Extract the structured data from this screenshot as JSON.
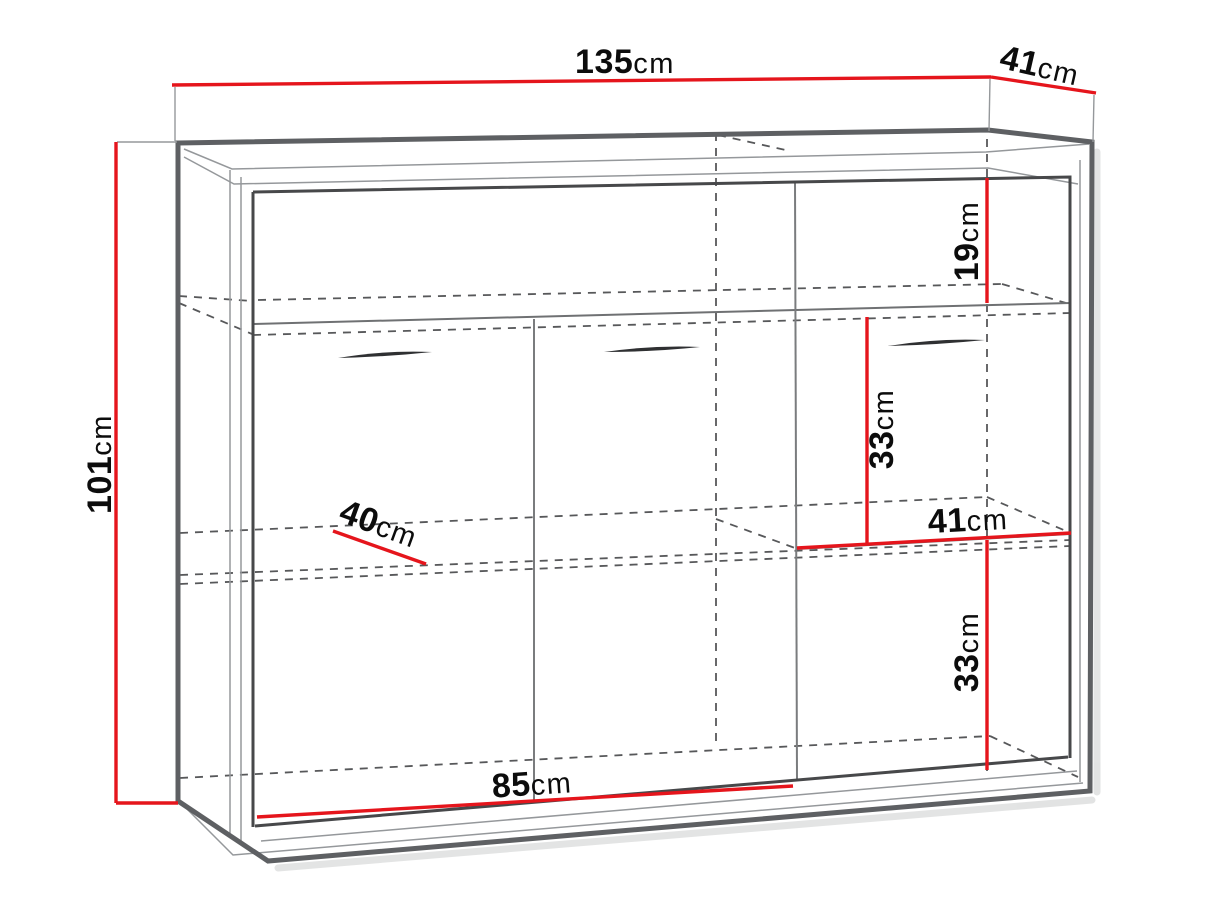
{
  "diagram": {
    "type": "furniture-dimension-diagram",
    "subject": "sideboard cabinet technical line drawing with red dimension lines",
    "background_color": "#ffffff",
    "accent_color": "#e5151c",
    "outline_color": "#5e6063",
    "hidden_line_color": "#57585a",
    "label_color": "#0c0c0c",
    "dimensions": {
      "width_total": {
        "value": "135",
        "unit": "cm",
        "label": "135cm"
      },
      "depth_total": {
        "value": "41",
        "unit": "cm",
        "label": "41cm"
      },
      "height_total": {
        "value": "101",
        "unit": "cm",
        "label": "101cm"
      },
      "top_niche_height": {
        "value": "19",
        "unit": "cm",
        "label": "19cm"
      },
      "right_upper_height": {
        "value": "33",
        "unit": "cm",
        "label": "33cm"
      },
      "right_compartment_width": {
        "value": "41",
        "unit": "cm",
        "label": "41cm"
      },
      "right_lower_height": {
        "value": "33",
        "unit": "cm",
        "label": "33cm"
      },
      "shelf_depth": {
        "value": "40",
        "unit": "cm",
        "label": "40cm"
      },
      "left_compartment_width": {
        "value": "85",
        "unit": "cm",
        "label": "85cm"
      }
    }
  }
}
